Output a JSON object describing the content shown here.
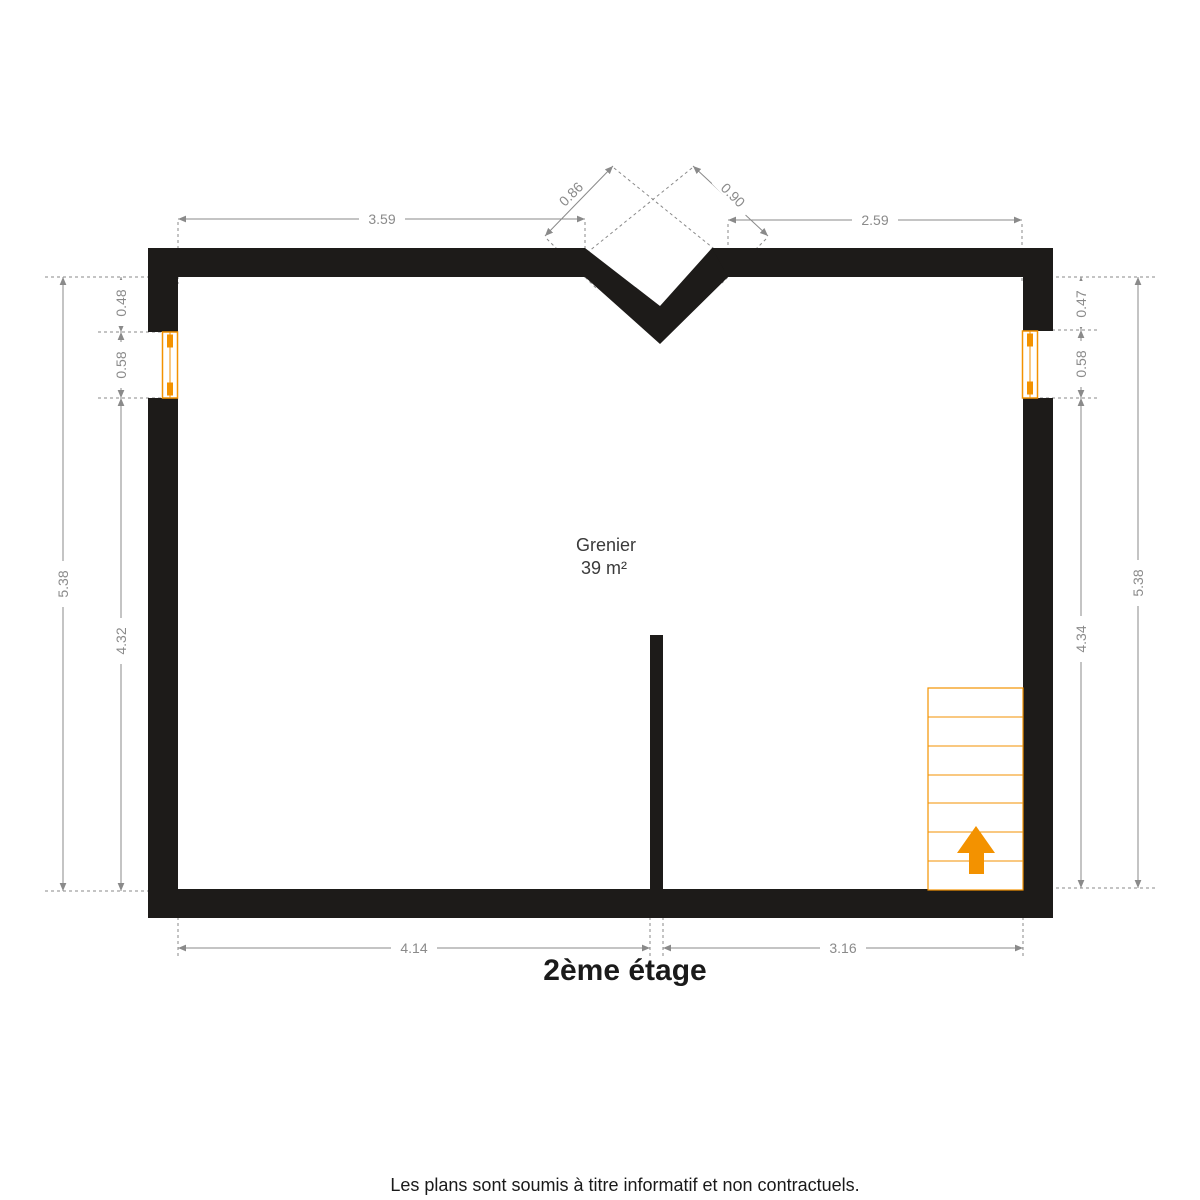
{
  "floor_title": "2ème étage",
  "footer_note": "Les plans sont soumis à titre informatif et non contractuels.",
  "room": {
    "name": "Grenier",
    "area": "39 m²"
  },
  "dims": {
    "top_left": "3.59",
    "notch_left": "0.86",
    "notch_right": "0.90",
    "top_right": "2.59",
    "left_outer": "5.38",
    "left_top": "0.48",
    "left_window": "0.58",
    "left_bottom": "4.32",
    "right_top": "0.47",
    "right_window": "0.58",
    "right_bottom": "4.34",
    "right_outer": "5.38",
    "bottom_left": "4.14",
    "bottom_right": "3.16"
  },
  "colors": {
    "wall": "#1d1b19",
    "dimension": "#8a8a8a",
    "accent": "#f39200",
    "room_text": "#3a3a3a",
    "title_text": "#1a1a1a"
  }
}
